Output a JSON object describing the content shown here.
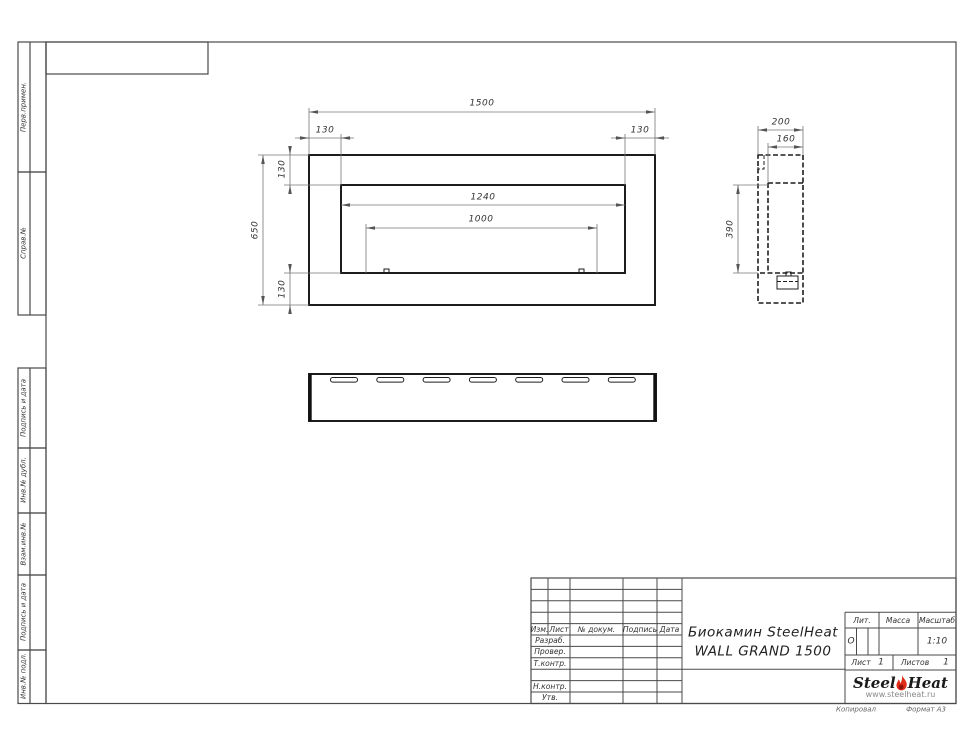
{
  "sheet": {
    "footer_copied": "Копировал",
    "footer_format": "Формат А3"
  },
  "margin_labels": {
    "perv_primen": "Перв.примен.",
    "sprav_no": "Справ.№",
    "podpis_data_1": "Подпись и дата",
    "inv_dubl": "Инв.№ дубл.",
    "vzam_inv": "Взам.инв.№",
    "podpis_data_2": "Подпись и дата",
    "inv_podl": "Инв.№ подл."
  },
  "dims": {
    "front_width": "1500",
    "front_left_offset": "130",
    "front_right_offset": "130",
    "front_height": "650",
    "front_top_offset": "130",
    "front_bottom_offset": "130",
    "front_opening_width": "1240",
    "front_burner_width": "1000",
    "side_depth": "200",
    "side_inner_depth": "160",
    "side_opening_height": "390"
  },
  "title_block": {
    "col_izm": "Изм.",
    "col_list": "Лист",
    "col_doc": "№ докум.",
    "col_sign": "Подпись",
    "col_date": "Дата",
    "row_razrab": "Разраб.",
    "row_prover": "Провер.",
    "row_tkontr": "Т.контр.",
    "row_nkontr": "Н.контр.",
    "row_utv": "Утв.",
    "title_line1": "Биокамин SteelHeat",
    "title_line2": "WALL GRAND 1500",
    "lit_label": "Лит.",
    "lit_value": "О",
    "mass_label": "Масса",
    "scale_label": "Масштаб",
    "scale_value": "1:10",
    "sheet_label": "Лист",
    "sheet_value": "1",
    "sheets_label": "Листов",
    "sheets_value": "1"
  },
  "logo": {
    "word1": "Steel",
    "word2": "Heat",
    "website": "www.steelheat.ru",
    "flame_color": "#e02b16"
  },
  "colors": {
    "contour": "#1d1d1d",
    "thin_line": "#777777",
    "frame_line": "#4a4a4a",
    "text": "#333333"
  }
}
